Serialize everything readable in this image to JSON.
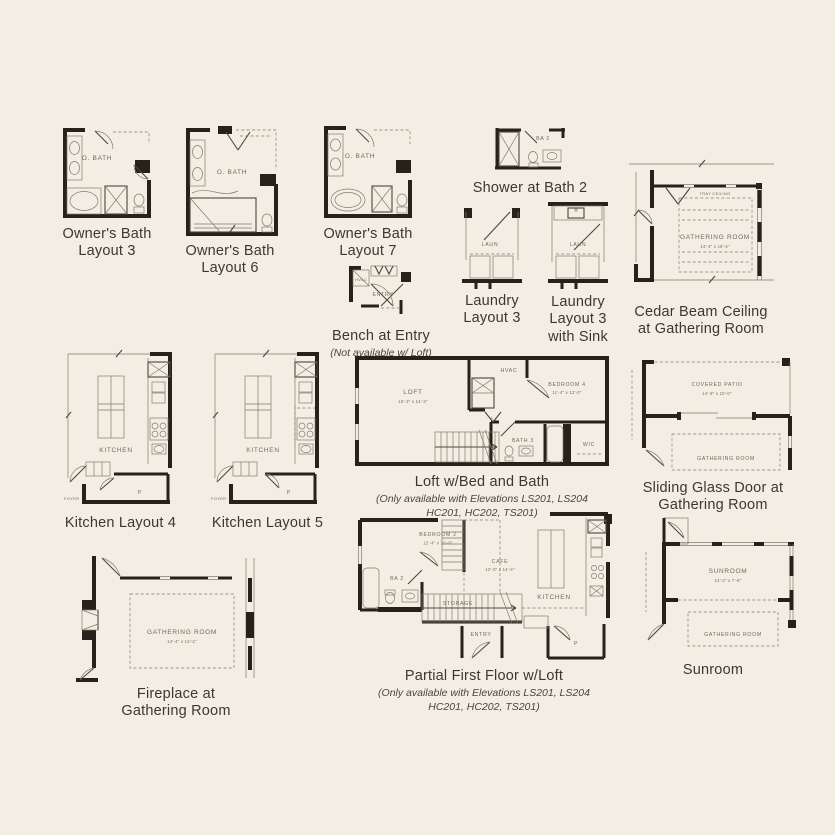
{
  "page": {
    "background": "#f3eee3",
    "wall_color": "#26221b",
    "caption_color": "#3c3731"
  },
  "plans": {
    "owners_bath_3": {
      "caption": [
        "Owner's Bath",
        "Layout 3"
      ],
      "labels": {
        "room": "O. BATH"
      }
    },
    "owners_bath_6": {
      "caption": [
        "Owner's Bath",
        "Layout 6"
      ],
      "labels": {
        "room": "O. BATH"
      }
    },
    "owners_bath_7": {
      "caption": [
        "Owner's Bath",
        "Layout 7"
      ],
      "labels": {
        "room": "O. BATH"
      }
    },
    "shower_bath2": {
      "caption": [
        "Shower at Bath 2"
      ],
      "labels": {
        "room": "BA 2"
      }
    },
    "cedar_beam": {
      "caption": [
        "Cedar Beam Ceiling",
        "at Gathering Room"
      ],
      "labels": {
        "room": "GATHERING ROOM",
        "dims": "14'-4\" x 18'-4\"",
        "ceiling_note": "TRAY CEILING"
      }
    },
    "laundry_3": {
      "caption": [
        "Laundry",
        "Layout 3"
      ],
      "labels": {
        "room": "LAUN"
      }
    },
    "laundry_3_sink": {
      "caption": [
        "Laundry",
        "Layout 3",
        "with Sink"
      ],
      "labels": {
        "room": "LAUN"
      }
    },
    "bench_entry": {
      "caption": [
        "Bench at Entry"
      ],
      "note": [
        "(Not available w/ Loft)"
      ],
      "labels": {
        "hvac": "HVAC",
        "entry": "ENTRY"
      }
    },
    "kitchen_4": {
      "caption": [
        "Kitchen Layout 4"
      ],
      "labels": {
        "room": "KITCHEN",
        "pantry": "P",
        "foyer": "FOYER"
      }
    },
    "kitchen_5": {
      "caption": [
        "Kitchen Layout 5"
      ],
      "labels": {
        "room": "KITCHEN",
        "pantry": "P",
        "foyer": "FOYER"
      }
    },
    "loft": {
      "caption": [
        "Loft w/Bed and Bath"
      ],
      "note": [
        "(Only available with Elevations LS201, LS204",
        "HC201, HC202, TS201)"
      ],
      "labels": {
        "loft": "LOFT",
        "loft_dims": "16'-3\" x 14'-3\"",
        "hvac": "HVAC",
        "bedroom": "BEDROOM 4",
        "bedroom_dims": "11'-4\" x 12'-0\"",
        "bath": "BATH 3",
        "wic": "WIC",
        "linen": "L"
      }
    },
    "sliding_door": {
      "caption": [
        "Sliding Glass Door at",
        "Gathering Room"
      ],
      "labels": {
        "patio": "COVERED PATIO",
        "patio_dims": "14'-8\" x 10'-0\"",
        "room": "GATHERING ROOM"
      }
    },
    "fireplace": {
      "caption": [
        "Fireplace at",
        "Gathering Room"
      ],
      "labels": {
        "room": "GATHERING ROOM",
        "dims": "14'-4\" x 13'-2\""
      }
    },
    "partial_first": {
      "caption": [
        "Partial First Floor w/Loft"
      ],
      "note": [
        "(Only available with Elevations LS201, LS204",
        "HC201, HC202, TS201)"
      ],
      "labels": {
        "bedroom": "BEDROOM 2",
        "bedroom_dims": "12'-4\" x 10'-8\"",
        "bath": "BA 2",
        "cafe": "CAFE",
        "cafe_dims": "12'-0\" x 14'-4\"",
        "storage": "STORAGE",
        "entry": "ENTRY",
        "kitchen": "KITCHEN",
        "pantry": "P"
      }
    },
    "sunroom": {
      "caption": [
        "Sunroom"
      ],
      "labels": {
        "room": "SUNROOM",
        "dims": "14'-2\" x 7'-8\"",
        "gathering": "GATHERING ROOM"
      }
    }
  }
}
